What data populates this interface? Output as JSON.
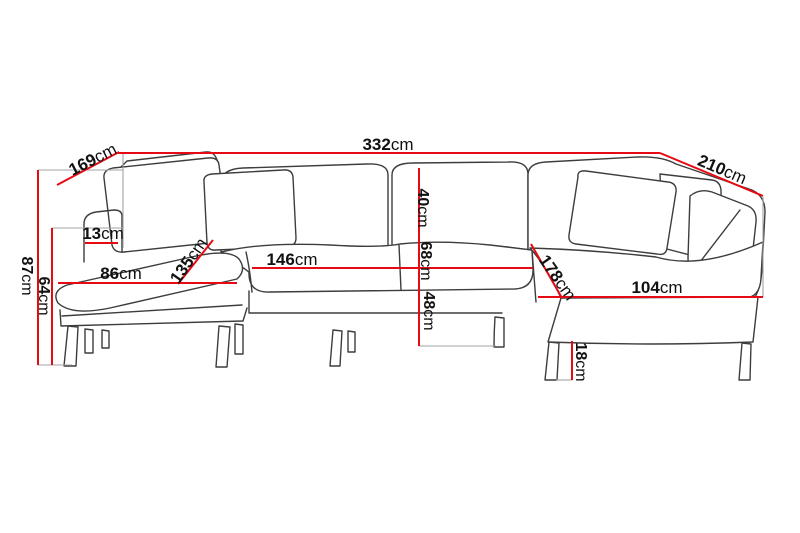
{
  "diagram": {
    "title": "corner-sofa-dimension-diagram",
    "unit": "cm",
    "colors": {
      "dimension_line": "#e60a12",
      "extension_line": "#a3a3a3",
      "sofa_outline": "#3d3d3d",
      "label_text": "#111111",
      "background": "#ffffff"
    },
    "measurements": [
      {
        "name": "total-width",
        "value": "332",
        "unit": "cm"
      },
      {
        "name": "left-side-depth",
        "value": "169",
        "unit": "cm"
      },
      {
        "name": "right-side-depth",
        "value": "210",
        "unit": "cm"
      },
      {
        "name": "total-height",
        "value": "87",
        "unit": "cm"
      },
      {
        "name": "armrest-height",
        "value": "64",
        "unit": "cm"
      },
      {
        "name": "armrest-width",
        "value": "13",
        "unit": "cm"
      },
      {
        "name": "left-chaise-seat-width",
        "value": "86",
        "unit": "cm"
      },
      {
        "name": "left-chaise-depth",
        "value": "135",
        "unit": "cm"
      },
      {
        "name": "middle-seat-width",
        "value": "146",
        "unit": "cm"
      },
      {
        "name": "back-cushion-height",
        "value": "40",
        "unit": "cm"
      },
      {
        "name": "seat-depth",
        "value": "68",
        "unit": "cm"
      },
      {
        "name": "seat-height",
        "value": "48",
        "unit": "cm"
      },
      {
        "name": "right-chaise-depth",
        "value": "178",
        "unit": "cm"
      },
      {
        "name": "right-chaise-seat-width",
        "value": "104",
        "unit": "cm"
      },
      {
        "name": "leg-height",
        "value": "18",
        "unit": "cm"
      }
    ]
  }
}
